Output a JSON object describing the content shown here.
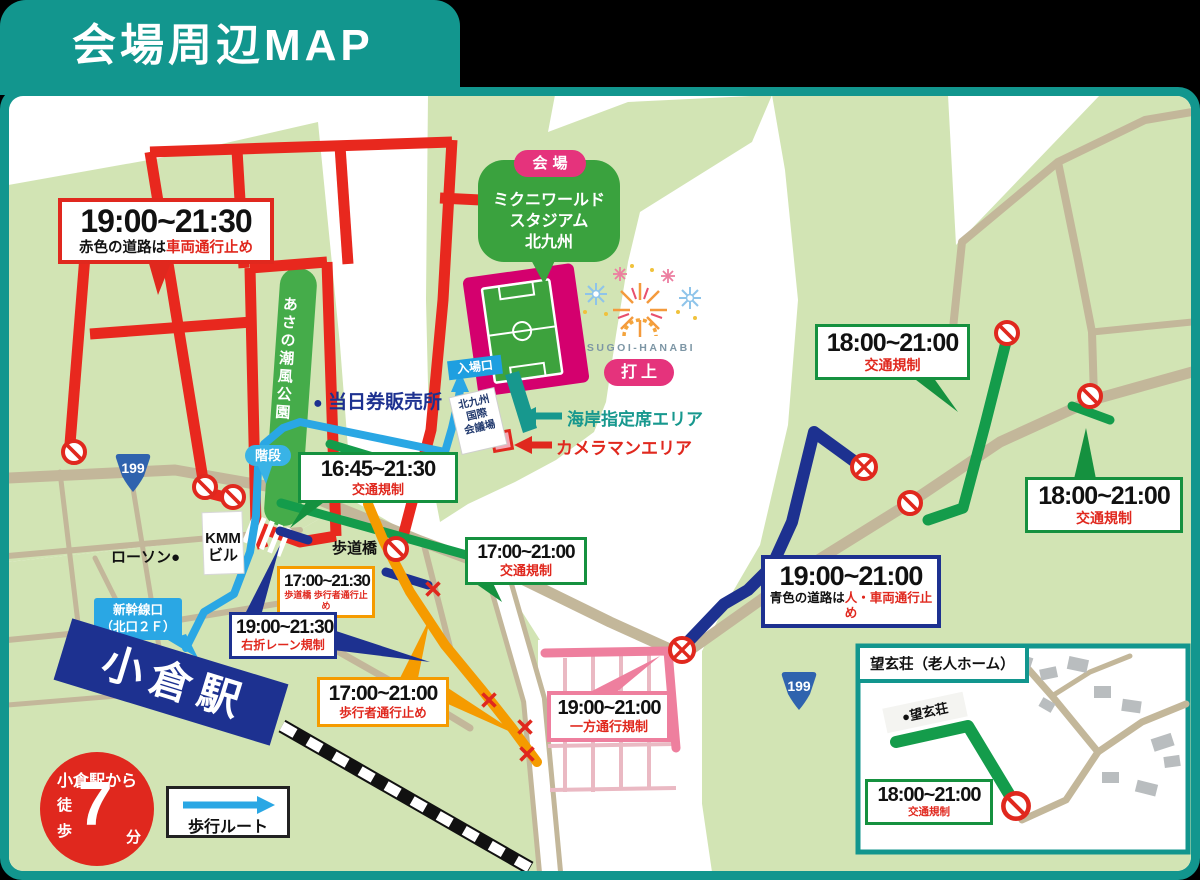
{
  "header": {
    "title": "会場周辺MAP"
  },
  "venue": {
    "badge": "会場",
    "name_line1": "ミクニワールド",
    "name_line2": "スタジアム",
    "name_line3": "北九州",
    "entrance": "入場口",
    "hanabi": "SUGOI-HANABI",
    "launch": "打上"
  },
  "labels": {
    "park": "あさの潮風公園",
    "ticket_dot": "●",
    "ticket": "当日券販売所",
    "stairs": "階段",
    "bridge": "歩道橋",
    "lawson": "ローソン●",
    "kmm1": "KMM",
    "kmm2": "ビル",
    "conf1": "北九州",
    "conf2": "国際",
    "conf3": "会議場",
    "shinkansen1": "新幹線口",
    "shinkansen2": "（北口２Ｆ）",
    "station": "小倉駅",
    "seaside": "海岸指定席エリア",
    "cameraman": "カメラマンエリア",
    "route199": "199"
  },
  "boxes": {
    "red_road": {
      "time": "19:00~21:30",
      "prefix": "赤色の道路は",
      "restriction": "車両通行止め"
    },
    "traffic_1645": {
      "time": "16:45~21:30",
      "restriction": "交通規制"
    },
    "bridge_closed": {
      "time": "17:00~21:30",
      "restriction": "歩道橋 歩行者通行止め"
    },
    "right_turn": {
      "time": "19:00~21:30",
      "restriction": "右折レーン規制"
    },
    "traffic_1700": {
      "time": "17:00~21:00",
      "restriction": "交通規制"
    },
    "pedestrian": {
      "time": "17:00~21:00",
      "restriction": "歩行者通行止め"
    },
    "one_way": {
      "time": "19:00~21:00",
      "restriction": "一方通行規制"
    },
    "blue_road": {
      "time": "19:00~21:00",
      "prefix": "青色の道路は",
      "restriction": "人・車両通行止め"
    },
    "traffic_18_a": {
      "time": "18:00~21:00",
      "restriction": "交通規制"
    },
    "traffic_18_b": {
      "time": "18:00~21:00",
      "restriction": "交通規制"
    },
    "traffic_18_inset": {
      "time": "18:00~21:00",
      "restriction": "交通規制"
    }
  },
  "inset": {
    "title": "望玄荘（老人ホーム）",
    "building": "●望玄荘"
  },
  "walk_badge": {
    "line1": "小倉駅から",
    "v1": "徒",
    "v2": "歩",
    "num": "7",
    "unit": "分"
  },
  "legend": {
    "walk_route": "歩行ルート"
  },
  "colors": {
    "teal": "#12968e",
    "land": "#d2e4b4",
    "road": "#c3b79a",
    "red": "#e8281e",
    "blue_walk": "#2aa7e4",
    "navy": "#1d3190",
    "green": "#149c4b",
    "orange": "#f59b00",
    "pink": "#ee7f9e",
    "magenta": "#d4006e"
  }
}
